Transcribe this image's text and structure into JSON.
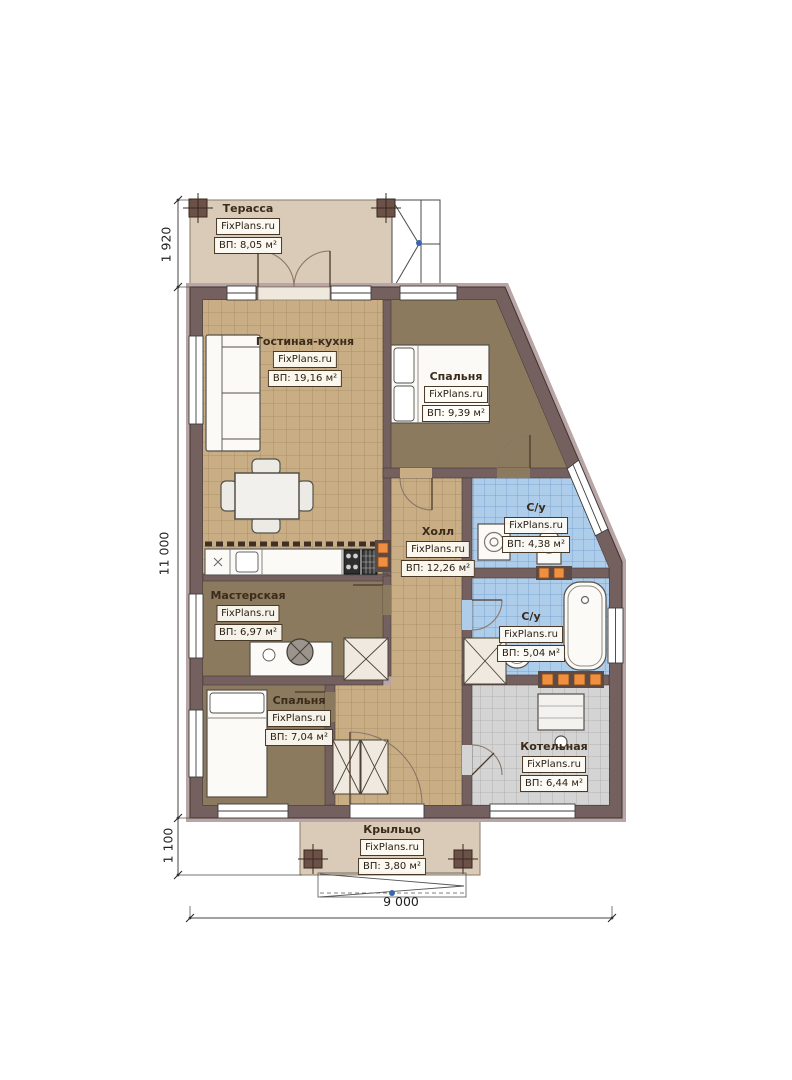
{
  "brand": "FixPlans.ru",
  "rooms": [
    {
      "key": "terrace",
      "name": "Терасса",
      "area": "ВП: 8,05 м²"
    },
    {
      "key": "living",
      "name": "Гостиная-кухня",
      "area": "ВП: 19,16 м²"
    },
    {
      "key": "bedroom1",
      "name": "Спальня",
      "area": "ВП: 9,39 м²"
    },
    {
      "key": "hall",
      "name": "Холл",
      "area": "ВП: 12,26 м²"
    },
    {
      "key": "bath1",
      "name": "С/у",
      "area": "ВП: 4,38 м²"
    },
    {
      "key": "bath2",
      "name": "С/у",
      "area": "ВП: 5,04 м²"
    },
    {
      "key": "workshop",
      "name": "Мастерская",
      "area": "ВП: 6,97 м²"
    },
    {
      "key": "bedroom2",
      "name": "Спальня",
      "area": "ВП: 7,04 м²"
    },
    {
      "key": "boiler",
      "name": "Котельная",
      "area": "ВП: 6,44 м²"
    },
    {
      "key": "porch",
      "name": "Крыльцо",
      "area": "ВП: 3,80 м²"
    }
  ],
  "dimensions": {
    "terrace_depth": "1 920",
    "house_depth": "11 000",
    "porch_depth": "1 100",
    "house_width": "9 000"
  },
  "colors": {
    "wall": "#756060",
    "wall_highlight": "#b9a5a5",
    "tile_tan": "#c9ae85",
    "floor_brown": "#8c7a5e",
    "tile_blue": "#aecdea",
    "tile_gray": "#d4d4d4",
    "terrace_floor": "#d9cbb7",
    "radiator_accent": "#ef8f3f",
    "marker_blue": "#3a66b0"
  }
}
